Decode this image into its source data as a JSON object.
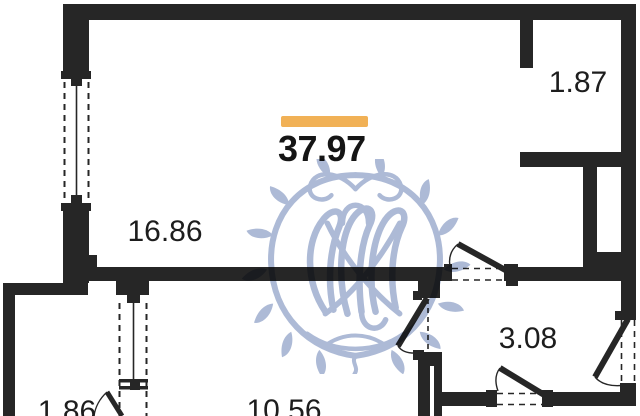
{
  "plan": {
    "title": "apartment floor plan",
    "total_area": "37.97",
    "accent_color": "#f1b156",
    "wall_color": "#262626",
    "watermark_color": "#a7b5d3",
    "rooms": [
      {
        "id": "living-room",
        "area": "16.86"
      },
      {
        "id": "niche-top-right",
        "area": "1.87"
      },
      {
        "id": "hallway",
        "area": "3.08"
      },
      {
        "id": "kitchen",
        "area": "10.56"
      },
      {
        "id": "balcony",
        "area": "1.86"
      }
    ]
  }
}
